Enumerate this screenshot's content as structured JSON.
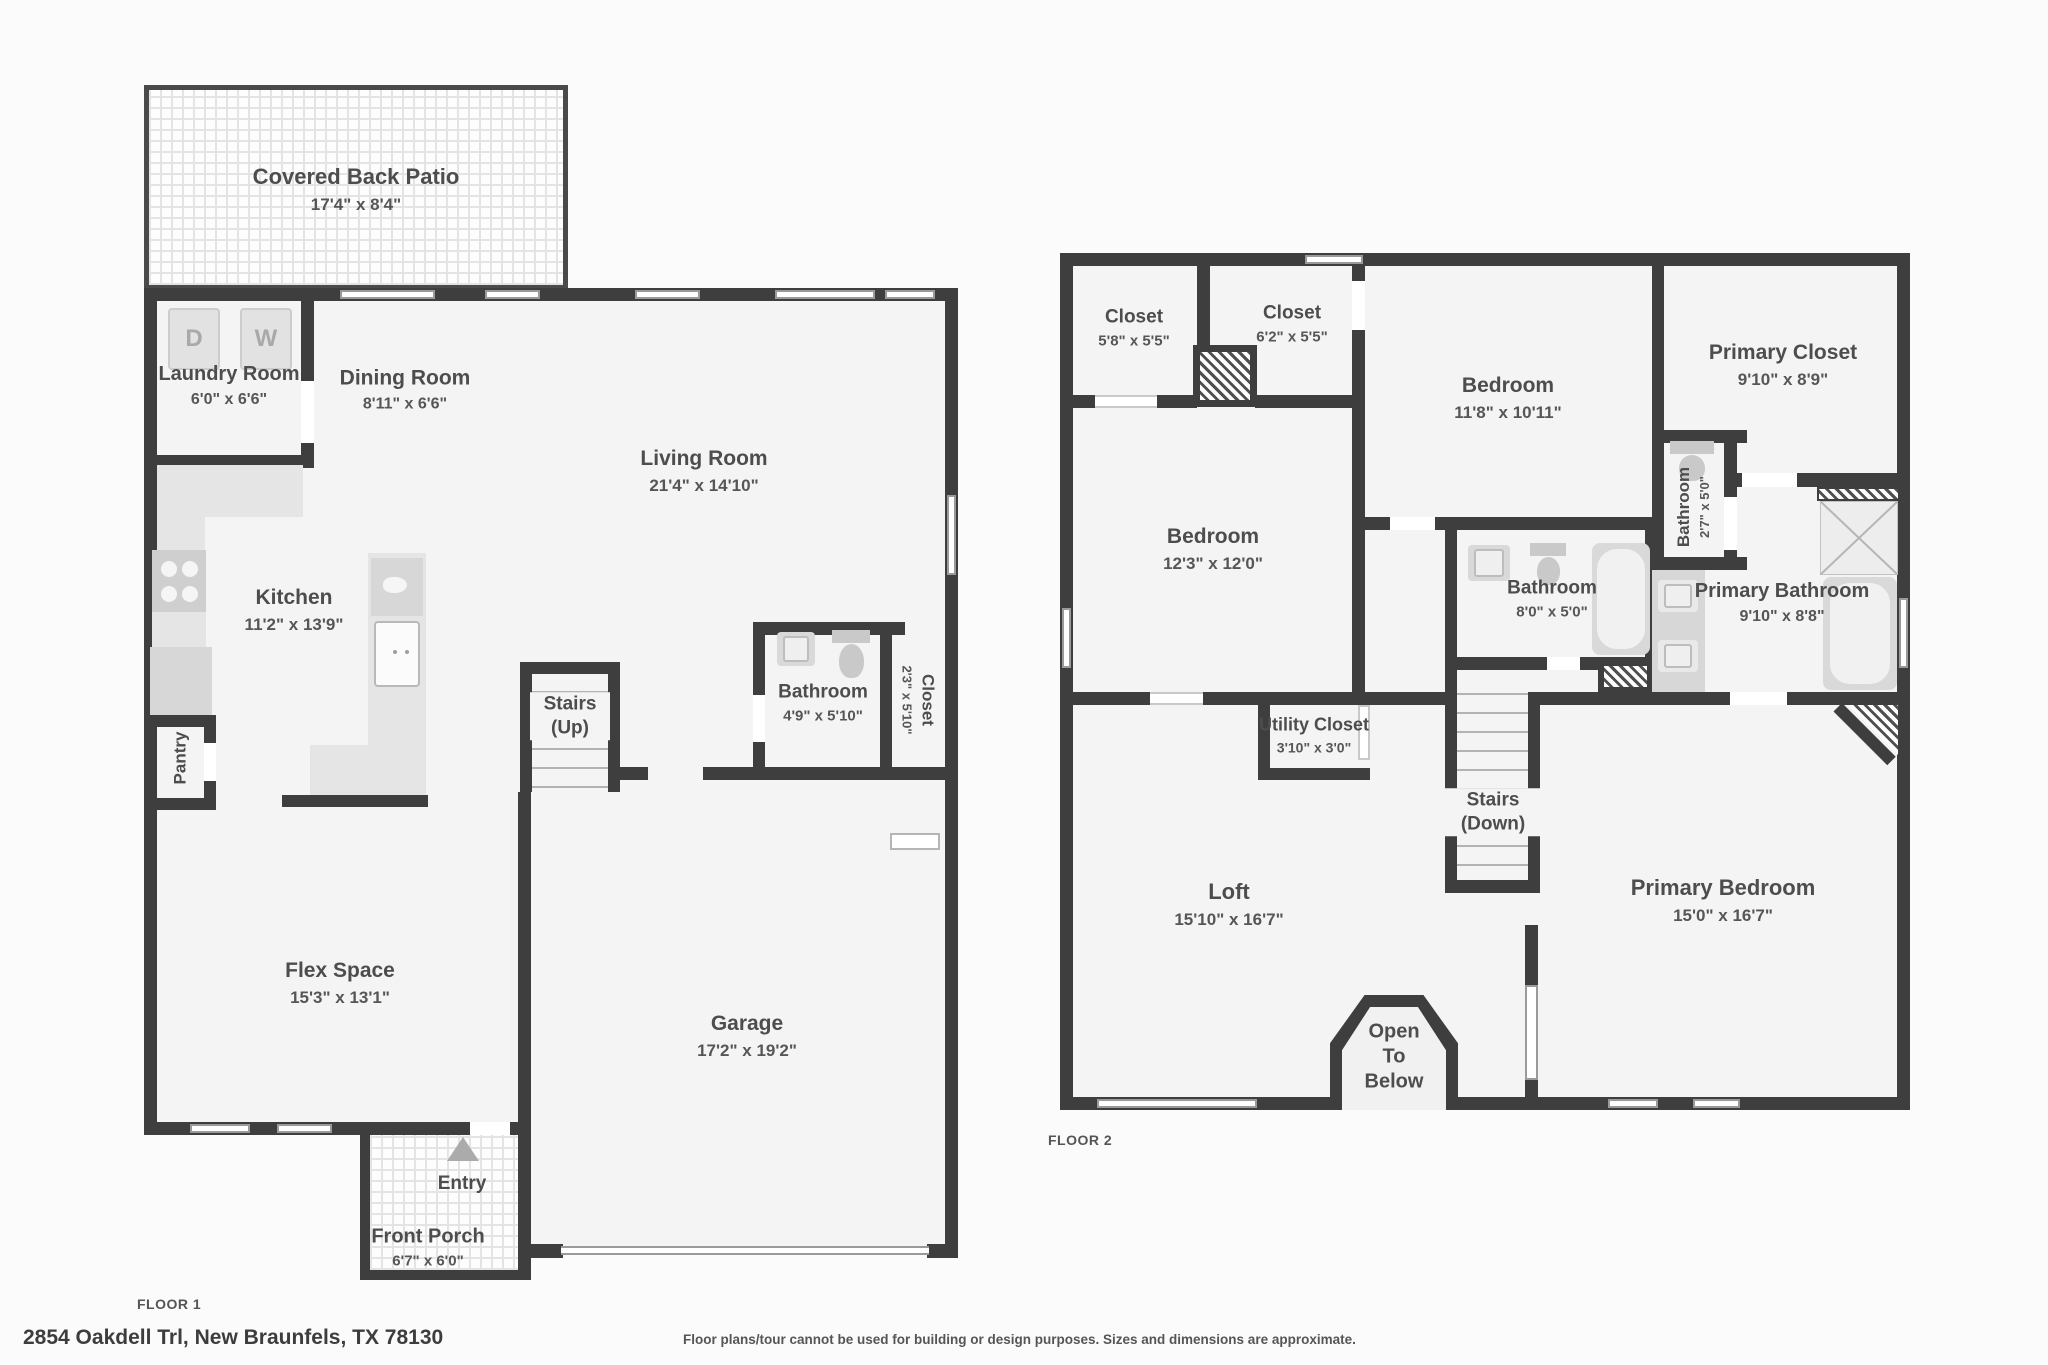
{
  "colors": {
    "wall": "#3e3e3e",
    "room_fill": "#f4f4f4",
    "text": "#4d4d4d",
    "fixture": "#d9d9d9",
    "patio_tile": "#e4e4e4"
  },
  "floor1": {
    "label": "FLOOR 1",
    "appliances": {
      "dryer": "D",
      "washer": "W"
    },
    "rooms": {
      "patio": {
        "name": "Covered Back Patio",
        "dims": "17'4\" x 8'4\""
      },
      "laundry": {
        "name": "Laundry Room",
        "dims": "6'0\" x 6'6\""
      },
      "dining": {
        "name": "Dining Room",
        "dims": "8'11\" x 6'6\""
      },
      "living": {
        "name": "Living Room",
        "dims": "21'4\" x 14'10\""
      },
      "kitchen": {
        "name": "Kitchen",
        "dims": "11'2\" x 13'9\""
      },
      "pantry": {
        "name": "Pantry"
      },
      "stairs": {
        "name": "Stairs (Up)"
      },
      "bathroom": {
        "name": "Bathroom",
        "dims": "4'9\" x 5'10\""
      },
      "closet": {
        "name": "Closet",
        "dims": "2'3\" x 5'10\""
      },
      "flex": {
        "name": "Flex Space",
        "dims": "15'3\" x 13'1\""
      },
      "garage": {
        "name": "Garage",
        "dims": "17'2\" x 19'2\""
      },
      "entry": {
        "name": "Entry"
      },
      "porch": {
        "name": "Front Porch",
        "dims": "6'7\" x 6'0\""
      }
    }
  },
  "floor2": {
    "label": "FLOOR 2",
    "rooms": {
      "closet1": {
        "name": "Closet",
        "dims": "5'8\" x 5'5\""
      },
      "closet2": {
        "name": "Closet",
        "dims": "6'2\" x 5'5\""
      },
      "bedroom1": {
        "name": "Bedroom",
        "dims": "12'3\" x 12'0\""
      },
      "bedroom2": {
        "name": "Bedroom",
        "dims": "11'8\" x 10'11\""
      },
      "primary_closet": {
        "name": "Primary Closet",
        "dims": "9'10\" x 8'9\""
      },
      "bathroom_small": {
        "name": "Bathroom",
        "dims": "2'7\" x 5'0\""
      },
      "bathroom_hall": {
        "name": "Bathroom",
        "dims": "8'0\" x 5'0\""
      },
      "primary_bathroom": {
        "name": "Primary Bathroom",
        "dims": "9'10\" x 8'8\""
      },
      "utility": {
        "name": "Utility Closet",
        "dims": "3'10\" x 3'0\""
      },
      "stairs": {
        "name": "Stairs (Down)"
      },
      "loft": {
        "name": "Loft",
        "dims": "15'10\" x 16'7\""
      },
      "primary_bedroom": {
        "name": "Primary Bedroom",
        "dims": "15'0\" x 16'7\""
      },
      "open_below": {
        "name": "Open To Below"
      }
    }
  },
  "footer": {
    "address": "2854 Oakdell Trl, New Braunfels, TX 78130",
    "disclaimer": "Floor plans/tour cannot be used for building or design purposes. Sizes and dimensions are approximate."
  }
}
